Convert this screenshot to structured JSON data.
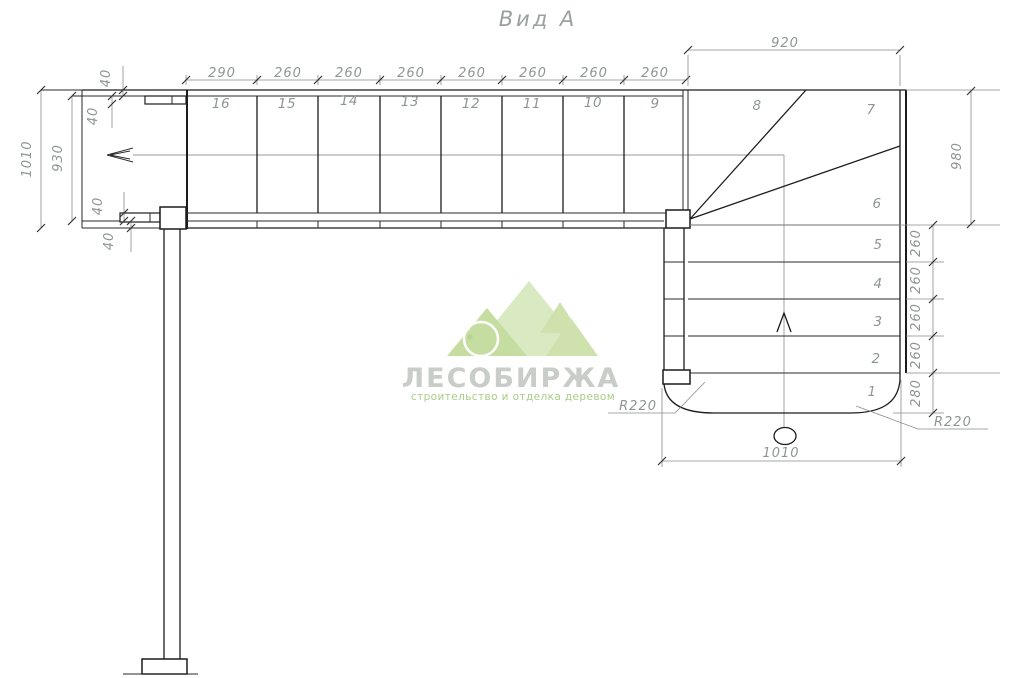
{
  "title": "Вид А",
  "upper_flight": {
    "dim_labels": [
      "290",
      "260",
      "260",
      "260",
      "260",
      "260",
      "260",
      "260"
    ],
    "steps": [
      "16",
      "15",
      "14",
      "13",
      "12",
      "11",
      "10",
      "9"
    ]
  },
  "winder": {
    "steps": [
      "8",
      "7"
    ],
    "width": "920",
    "height": "980"
  },
  "lower_flight": {
    "steps": [
      "6",
      "5",
      "4",
      "3",
      "2",
      "1"
    ],
    "dim_labels": [
      "260",
      "260",
      "260",
      "260"
    ],
    "first_step_depth": "280",
    "width": "1010",
    "radius_left": "R220",
    "radius_right": "R220"
  },
  "landing": {
    "overall": "1010",
    "clear": "930",
    "offsets": [
      "40",
      "40",
      "40",
      "40"
    ]
  },
  "watermark": {
    "name": "ЛЕСОБИРЖА",
    "tagline": "строительство и отделка деревом",
    "green": "#cfe2ae",
    "green_light": "#dceadf",
    "text_gray": "#c9cdc9"
  },
  "colors": {
    "line": "#1c1c1c",
    "dimension": "#8f9595",
    "background": "#ffffff"
  }
}
